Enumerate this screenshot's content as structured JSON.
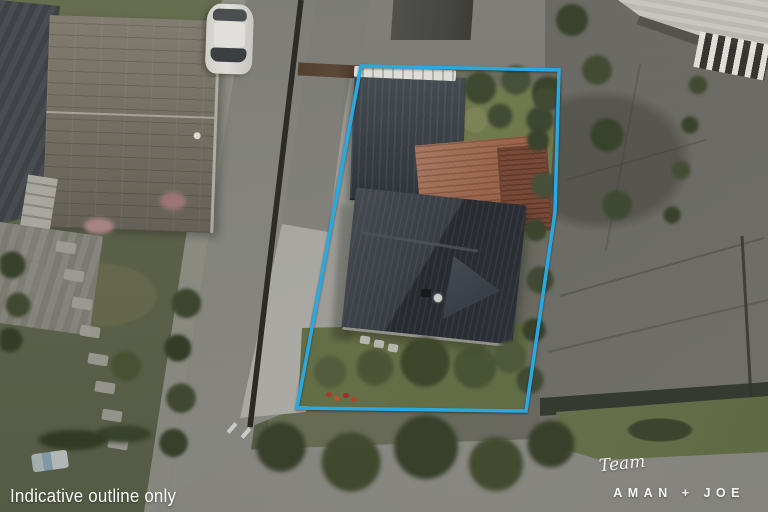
{
  "watermark": {
    "disclaimer": "Indicative outline only"
  },
  "branding": {
    "script": "Team",
    "name": "AMAN + JOE"
  },
  "property_outline": {
    "color": "#29a9e1",
    "stroke_width": "3.5",
    "points": "361,66 559,70 555,212 526,411 297,408"
  },
  "palette": {
    "lawn_left": "#5f644a",
    "lawn_property": "#6c784e",
    "road": "#8b8a85",
    "footpath": "#9a9993",
    "driveway": "#b2b1ab",
    "concrete_right": "#6e6d68",
    "main_roof": "#32373f",
    "garage_roof": "#3a4149",
    "garage_ridge": "#e7e6e1",
    "neighbor_roof": "#7b7467",
    "deck": "#a2684d",
    "deck_dark": "#7e4a38",
    "trees_dark": "#3c4429",
    "building_roof_tr": "#d0cdc7",
    "fence_dark": "#2b2a24",
    "car_body": "#e8e7e3",
    "text_color": "#ffffff"
  }
}
